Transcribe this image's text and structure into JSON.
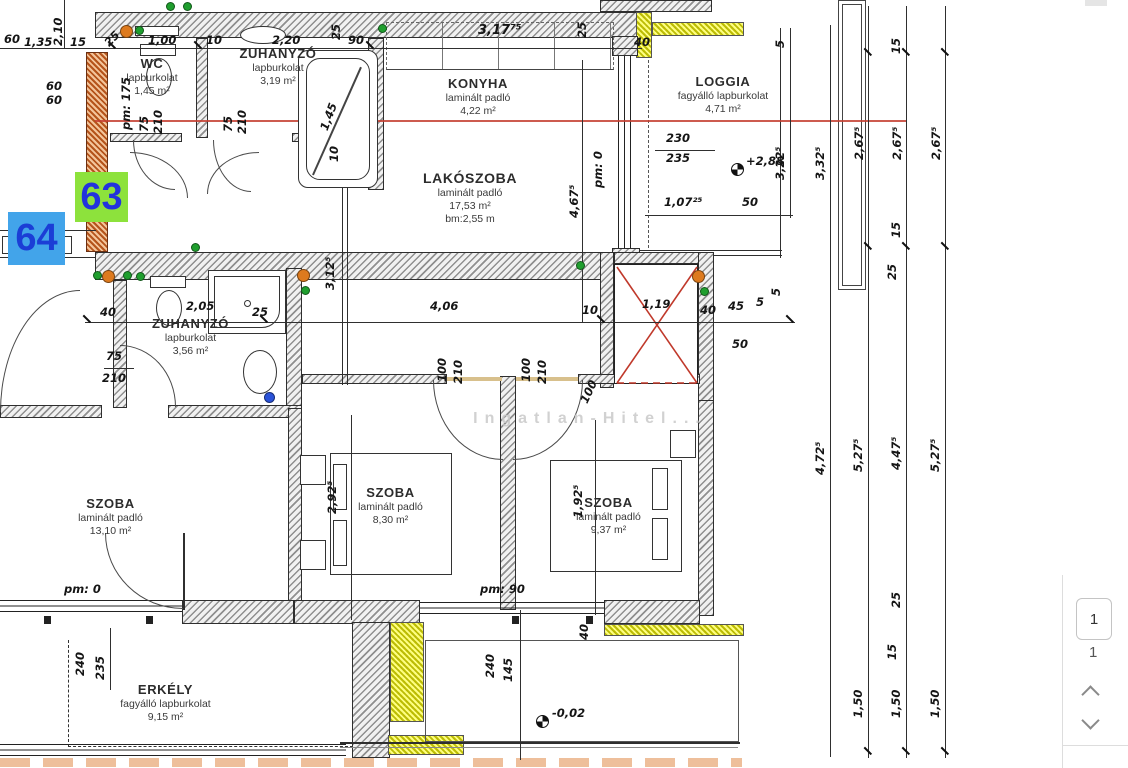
{
  "watermark": "Ingatlan-Hitel...",
  "badges": {
    "green_label": "63",
    "blue_label": "64",
    "green_bg": "#8de23c",
    "green_fg": "#2233dd",
    "blue_bg": "#42a4ea",
    "blue_fg": "#1b3ed6"
  },
  "viewer": {
    "page_button": "1",
    "page_count": "1"
  },
  "rooms": {
    "wc": {
      "name": "WC",
      "floor": "lapburkolat",
      "area": "1,45 m²"
    },
    "shower1": {
      "name": "ZUHANYZÓ",
      "floor": "lapburkolat",
      "area": "3,19 m²"
    },
    "kitchen": {
      "name": "KONYHA",
      "floor": "laminált padló",
      "area": "4,22 m²"
    },
    "living": {
      "name": "LAKÓSZOBA",
      "floor": "laminált padló",
      "area": "17,53 m²",
      "extra": "bm:2,55 m"
    },
    "loggia": {
      "name": "LOGGIA",
      "floor": "fagyálló lapburkolat",
      "area": "4,71 m²"
    },
    "shower2": {
      "name": "ZUHANYZÓ",
      "floor": "lapburkolat",
      "area": "3,56 m²"
    },
    "room1": {
      "name": "SZOBA",
      "floor": "laminált padló",
      "area": "13,10 m²"
    },
    "room2": {
      "name": "SZOBA",
      "floor": "laminált padló",
      "area": "8,30 m²"
    },
    "room3": {
      "name": "SZOBA",
      "floor": "laminált padló",
      "area": "9,37 m²"
    },
    "balcony": {
      "name": "ERKÉLY",
      "floor": "fagyálló lapburkolat",
      "area": "9,15 m²"
    }
  },
  "levels": [
    {
      "t": "+2,88",
      "x": 731,
      "y": 163,
      "tx": 746,
      "ty": 155
    },
    {
      "t": "-0,02",
      "x": 536,
      "y": 715,
      "tx": 552,
      "ty": 707
    }
  ],
  "dims": [
    {
      "t": "60",
      "x": 4,
      "y": 33
    },
    {
      "t": "2,10",
      "x": 52,
      "y": 46,
      "r": -90
    },
    {
      "t": "1,35",
      "x": 24,
      "y": 36
    },
    {
      "t": "15",
      "x": 70,
      "y": 36
    },
    {
      "t": "60",
      "x": 46,
      "y": 80
    },
    {
      "t": "60",
      "x": 46,
      "y": 94
    },
    {
      "t": "25",
      "x": 102,
      "y": 40,
      "r": -45
    },
    {
      "t": "1,00",
      "x": 148,
      "y": 34
    },
    {
      "t": "10",
      "x": 206,
      "y": 34
    },
    {
      "t": "2,20",
      "x": 272,
      "y": 34
    },
    {
      "t": "pm: 175",
      "x": 120,
      "y": 130,
      "r": -90
    },
    {
      "t": "75",
      "x": 138,
      "y": 132,
      "r": -90
    },
    {
      "t": "210",
      "x": 152,
      "y": 134,
      "r": -90
    },
    {
      "t": "75",
      "x": 222,
      "y": 132,
      "r": -90
    },
    {
      "t": "210",
      "x": 236,
      "y": 134,
      "r": -90
    },
    {
      "t": "25",
      "x": 330,
      "y": 40,
      "r": -90
    },
    {
      "t": "90",
      "x": 348,
      "y": 34
    },
    {
      "t": "1,45",
      "x": 318,
      "y": 128,
      "r": -70
    },
    {
      "t": "10",
      "x": 328,
      "y": 162,
      "r": -90
    },
    {
      "t": "3,17⁷⁵",
      "x": 478,
      "y": 24,
      "fs": 13
    },
    {
      "t": "25",
      "x": 576,
      "y": 38,
      "r": -90
    },
    {
      "t": "40",
      "x": 634,
      "y": 36
    },
    {
      "t": "5",
      "x": 774,
      "y": 48,
      "r": -90
    },
    {
      "t": "3,22⁵",
      "x": 774,
      "y": 180,
      "r": -90
    },
    {
      "t": "3,32⁵",
      "x": 814,
      "y": 180,
      "r": -90
    },
    {
      "t": "230",
      "x": 666,
      "y": 132
    },
    {
      "t": "235",
      "x": 666,
      "y": 152
    },
    {
      "t": "1,07²⁵",
      "x": 664,
      "y": 196
    },
    {
      "t": "50",
      "x": 742,
      "y": 196
    },
    {
      "t": "pm: 0",
      "x": 592,
      "y": 188,
      "r": -90
    },
    {
      "t": "5",
      "x": 770,
      "y": 296,
      "r": -90
    },
    {
      "t": "3,12⁵",
      "x": 324,
      "y": 290,
      "r": -90
    },
    {
      "t": "4,67⁵",
      "x": 568,
      "y": 218,
      "r": -90
    },
    {
      "t": "4,06",
      "x": 430,
      "y": 300
    },
    {
      "t": "10",
      "x": 582,
      "y": 304
    },
    {
      "t": "1,19",
      "x": 642,
      "y": 298
    },
    {
      "t": "40",
      "x": 700,
      "y": 304
    },
    {
      "t": "45",
      "x": 728,
      "y": 300
    },
    {
      "t": "5",
      "x": 756,
      "y": 296
    },
    {
      "t": "50",
      "x": 732,
      "y": 338
    },
    {
      "t": "40",
      "x": 100,
      "y": 306
    },
    {
      "t": "2,05",
      "x": 186,
      "y": 300
    },
    {
      "t": "25",
      "x": 252,
      "y": 306
    },
    {
      "t": "75",
      "x": 106,
      "y": 350
    },
    {
      "t": "210",
      "x": 102,
      "y": 372
    },
    {
      "t": "100",
      "x": 436,
      "y": 382,
      "r": -90
    },
    {
      "t": "210",
      "x": 452,
      "y": 384,
      "r": -90
    },
    {
      "t": "100",
      "x": 520,
      "y": 382,
      "r": -90
    },
    {
      "t": "210",
      "x": 536,
      "y": 384,
      "r": -90
    },
    {
      "t": "100",
      "x": 578,
      "y": 400,
      "r": -65
    },
    {
      "t": "2,92⁵",
      "x": 326,
      "y": 514,
      "r": -90
    },
    {
      "t": "1,92⁵",
      "x": 572,
      "y": 518,
      "r": -90
    },
    {
      "t": "pm: 90",
      "x": 480,
      "y": 583
    },
    {
      "t": "pm: 0",
      "x": 64,
      "y": 583
    },
    {
      "t": "40",
      "x": 578,
      "y": 640,
      "r": -90
    },
    {
      "t": "240",
      "x": 74,
      "y": 676,
      "r": -90
    },
    {
      "t": "235",
      "x": 94,
      "y": 680,
      "r": -90
    },
    {
      "t": "240",
      "x": 484,
      "y": 678,
      "r": -90
    },
    {
      "t": "145",
      "x": 502,
      "y": 682,
      "r": -90
    },
    {
      "t": "15",
      "x": 890,
      "y": 54,
      "r": -90
    },
    {
      "t": "2,67⁵",
      "x": 853,
      "y": 160,
      "r": -90
    },
    {
      "t": "2,67⁵",
      "x": 891,
      "y": 160,
      "r": -90
    },
    {
      "t": "2,67⁵",
      "x": 930,
      "y": 160,
      "r": -90
    },
    {
      "t": "15",
      "x": 890,
      "y": 238,
      "r": -90
    },
    {
      "t": "25",
      "x": 886,
      "y": 280,
      "r": -90
    },
    {
      "t": "4,72⁵",
      "x": 814,
      "y": 475,
      "r": -90
    },
    {
      "t": "5,27⁵",
      "x": 852,
      "y": 472,
      "r": -90
    },
    {
      "t": "4,47⁵",
      "x": 890,
      "y": 470,
      "r": -90
    },
    {
      "t": "5,27⁵",
      "x": 929,
      "y": 472,
      "r": -90
    },
    {
      "t": "25",
      "x": 890,
      "y": 608,
      "r": -90
    },
    {
      "t": "15",
      "x": 886,
      "y": 660,
      "r": -90
    },
    {
      "t": "1,50",
      "x": 852,
      "y": 718,
      "r": -90
    },
    {
      "t": "1,50",
      "x": 890,
      "y": 718,
      "r": -90
    },
    {
      "t": "1,50",
      "x": 929,
      "y": 718,
      "r": -90
    }
  ],
  "markers": [
    {
      "x": 126,
      "y": 31,
      "c": "orange"
    },
    {
      "x": 139,
      "y": 30,
      "c": "green"
    },
    {
      "x": 170,
      "y": 6,
      "c": "green"
    },
    {
      "x": 187,
      "y": 6,
      "c": "green"
    },
    {
      "x": 382,
      "y": 28,
      "c": "green"
    },
    {
      "x": 195,
      "y": 247,
      "c": "green"
    },
    {
      "x": 108,
      "y": 276,
      "c": "orange"
    },
    {
      "x": 97,
      "y": 275,
      "c": "green"
    },
    {
      "x": 127,
      "y": 275,
      "c": "green"
    },
    {
      "x": 140,
      "y": 276,
      "c": "green"
    },
    {
      "x": 303,
      "y": 275,
      "c": "orange"
    },
    {
      "x": 305,
      "y": 290,
      "c": "green"
    },
    {
      "x": 580,
      "y": 265,
      "c": "green"
    },
    {
      "x": 698,
      "y": 276,
      "c": "orange"
    },
    {
      "x": 704,
      "y": 291,
      "c": "green"
    },
    {
      "x": 269,
      "y": 397,
      "c": "blue"
    }
  ],
  "marker_colors": {
    "orange": "#dd7a1e",
    "green": "#1f9e2e",
    "blue": "#2a52d8"
  }
}
